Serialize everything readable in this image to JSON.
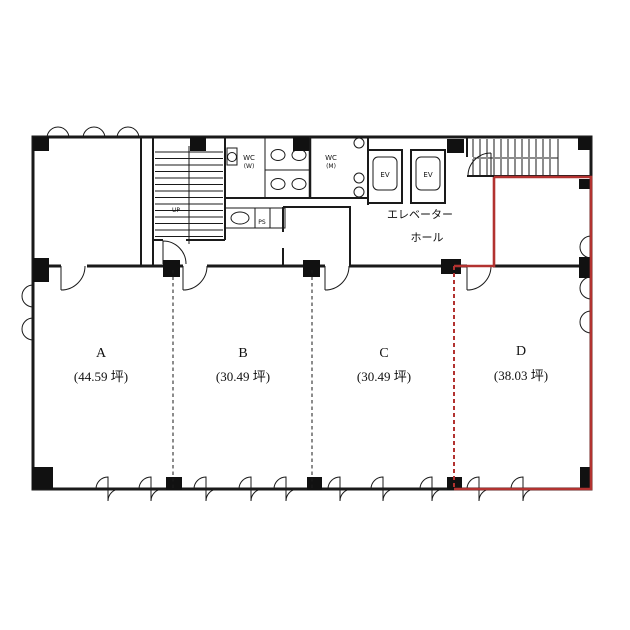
{
  "plan_title": "office-floor-plan",
  "highlighted_unit": "D",
  "units": [
    {
      "name": "A",
      "area": "(44.59 坪)"
    },
    {
      "name": "B",
      "area": "(30.49 坪)"
    },
    {
      "name": "C",
      "area": "(30.49 坪)"
    },
    {
      "name": "D",
      "area": "(38.03 坪)"
    }
  ],
  "core": {
    "wc_women_label": "WC",
    "wc_women_sub": "(W)",
    "wc_men_label": "WC",
    "wc_men_sub": "(M)",
    "elevator_1_label": "EV",
    "elevator_2_label": "EV",
    "hall_label_line1": "エレベーター",
    "hall_label_line2": "ホール",
    "pipe_shaft_label": "PS",
    "stair_up_label": "UP"
  },
  "colors": {
    "highlight_red": "#b23230",
    "wall_black": "#1a1a1a"
  }
}
